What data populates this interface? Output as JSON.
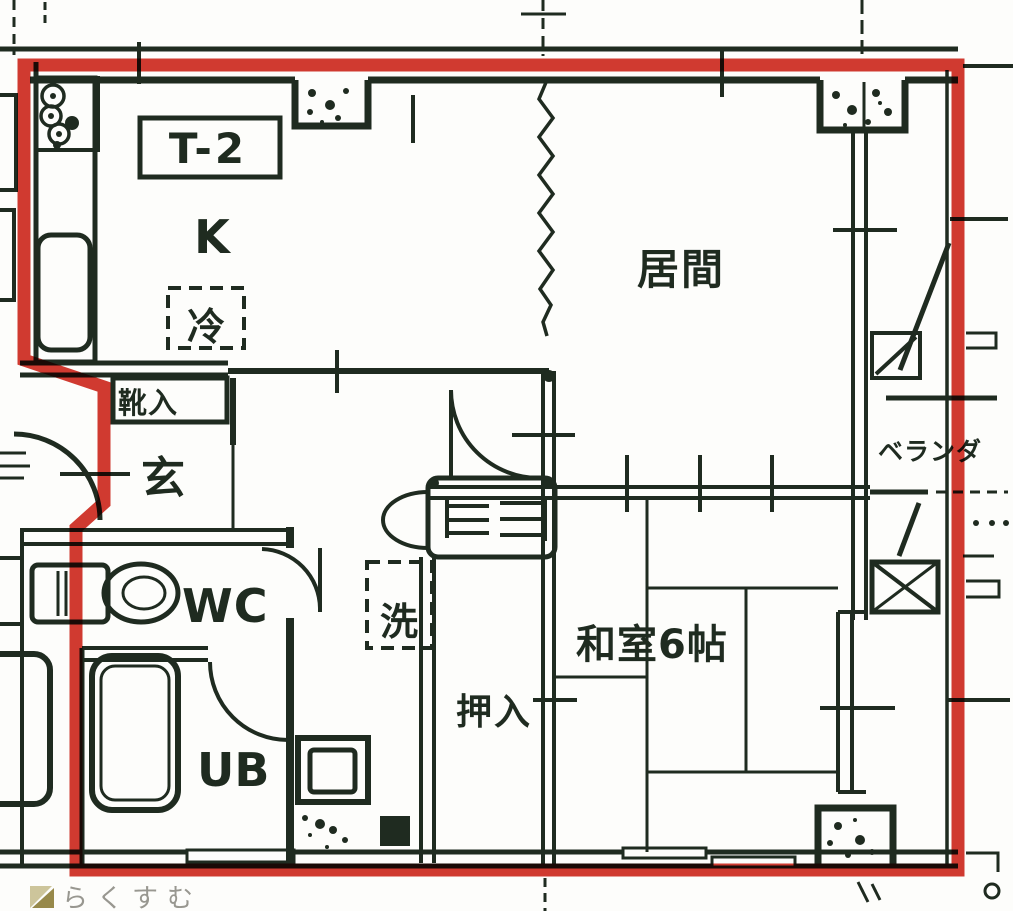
{
  "floorplan": {
    "unit_type_label": "T-2",
    "rooms": {
      "kitchen": "K",
      "living_room": "居間",
      "japanese_room": "和室6帖",
      "entrance": "玄",
      "toilet": "WC",
      "unit_bath": "UB",
      "closet": "押入",
      "veranda": "ベランダ"
    },
    "fixtures": {
      "refrigerator": "冷",
      "washing_machine": "洗",
      "shoe_cabinet": "靴入"
    },
    "colors": {
      "unit_outline_red": "#d23a30",
      "wall_ink": "#1f2b20",
      "paper": "#fdfdfb",
      "watermark_text": "#8e8d85",
      "watermark_icon_light": "#cdc59b",
      "watermark_icon_dark": "#97894a"
    },
    "watermark": {
      "text": "らくすむ"
    }
  }
}
